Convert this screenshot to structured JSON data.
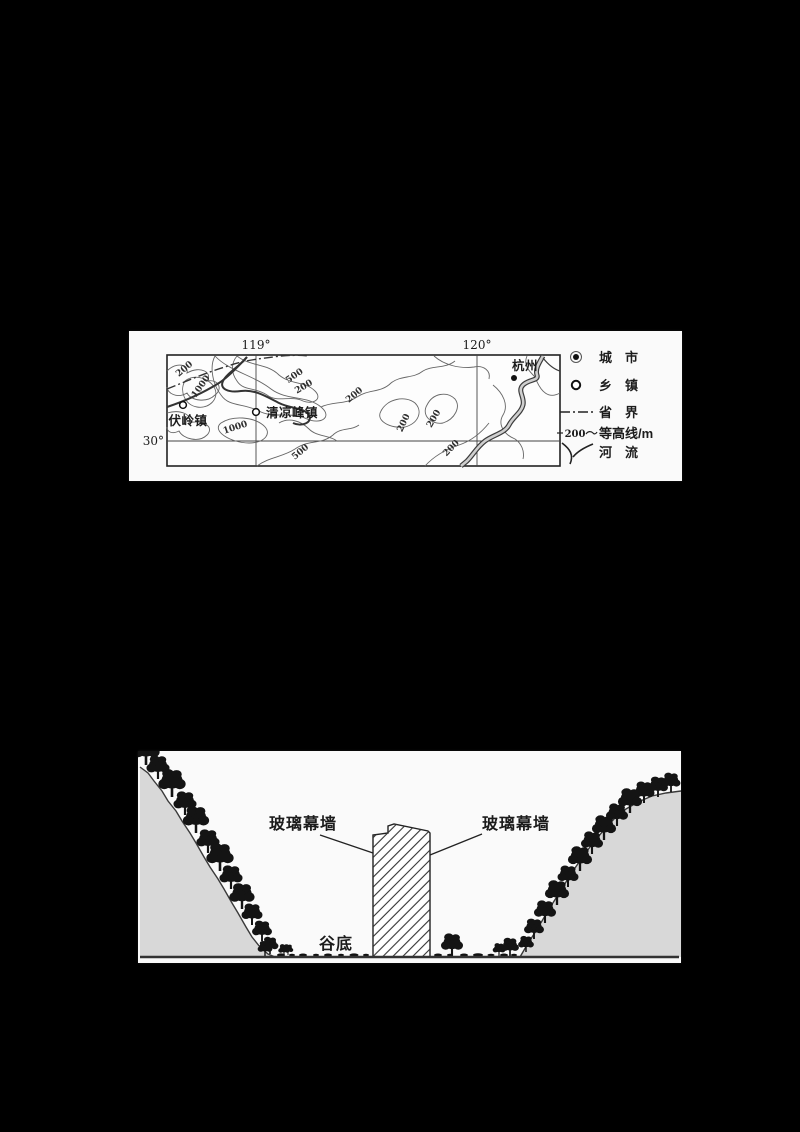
{
  "map_figure": {
    "lon_left": "119°",
    "lon_right": "120°",
    "lat_bottom_left": "30°",
    "city_label": "杭州",
    "town_label_left": "伏岭镇",
    "town_label_center": "清凉峰镇",
    "contour_values": [
      "200",
      "1000",
      "500",
      "200",
      "200",
      "1000",
      "500",
      "200",
      "200",
      "200"
    ],
    "legend": {
      "city": "城　市",
      "town": "乡　镇",
      "province_boundary": "省　界",
      "contour_label": "等高线/m",
      "contour_value": "200",
      "river": "河　流"
    }
  },
  "section_figure": {
    "glass_wall_left": "玻璃幕墙",
    "glass_wall_right": "玻璃幕墙",
    "valley_bottom": "谷底"
  },
  "colors": {
    "page_background": "#000000",
    "panel_background": "#fafafa",
    "line_ink": "#222222",
    "slope_fill": "#d8d8d8",
    "tree_fill": "#141414"
  }
}
